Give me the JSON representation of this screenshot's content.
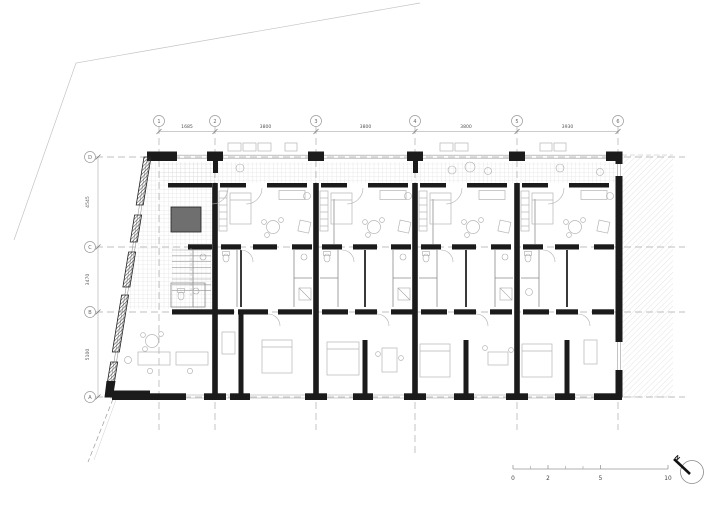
{
  "drawing": {
    "kind": "architectural-floor-plan",
    "description": "Residential floor plan with structural grid, dimension strings, tiled access gallery, neighbouring building hatch, scale bar and north arrow"
  },
  "grid": {
    "cols": [
      {
        "label": "1"
      },
      {
        "label": "2"
      },
      {
        "label": "3"
      },
      {
        "label": "4"
      },
      {
        "label": "5"
      },
      {
        "label": "6"
      }
    ],
    "rows": [
      {
        "label": "D"
      },
      {
        "label": "C"
      },
      {
        "label": "B"
      },
      {
        "label": "A"
      }
    ]
  },
  "dimensions": {
    "top": [
      "1685",
      "3800",
      "3800",
      "3800",
      "3930"
    ],
    "left": [
      "4545",
      "3470",
      "5100"
    ]
  },
  "scale_bar": {
    "labels": [
      "0",
      "2",
      "5",
      "10"
    ]
  },
  "north_arrow": {
    "label": "N"
  },
  "colors": {
    "wall": "#1b1b1b",
    "gridline": "#ababab",
    "tile": "#d6d6d6",
    "neighbour_hatch": "#d9d9d9",
    "furniture": "#b5b5b5",
    "dimension_text": "#555555"
  }
}
